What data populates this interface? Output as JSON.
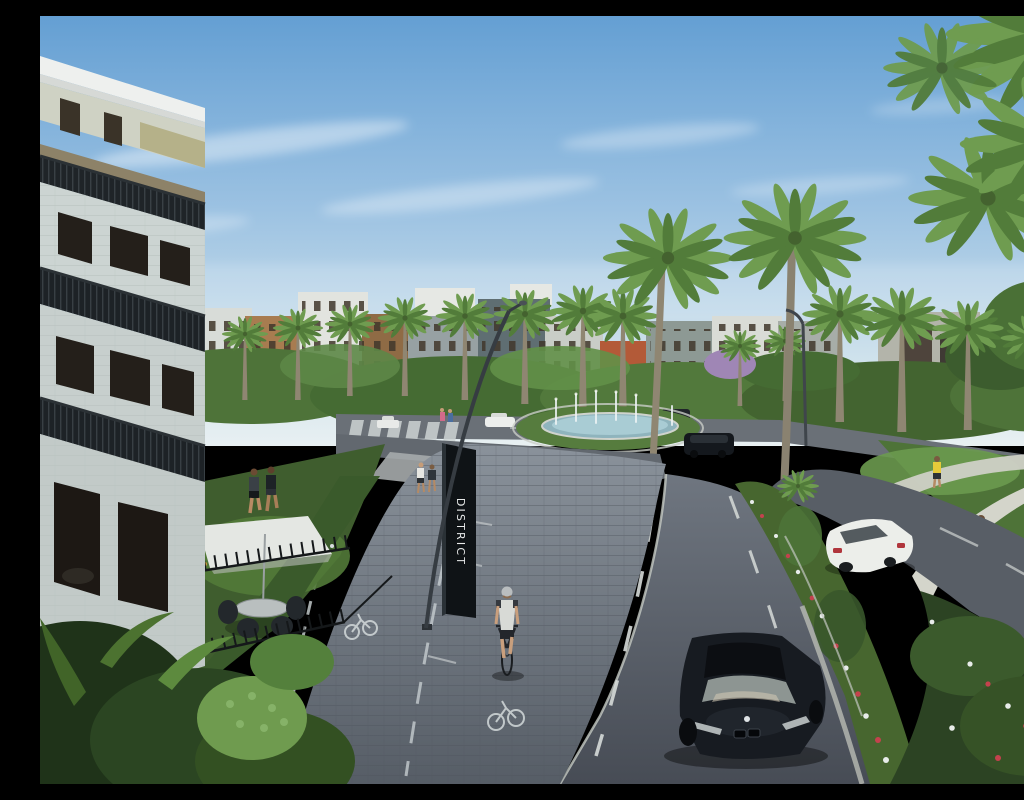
{
  "scene": {
    "kind": "photorealistic architectural rendering",
    "subject": "palm-lined boulevard curving through a modern residential community with a roundabout fountain, paver bike path and landscaped medians",
    "sky": "clear blue sky with thin wispy clouds"
  },
  "sign": {
    "label": "DISTRICT",
    "panel_color": "#0f1316",
    "text_color": "#e8eaea"
  },
  "palette": {
    "sky_top": "#649fd3",
    "sky_horizon": "#e8f0f2",
    "asphalt_near": "#474c55",
    "asphalt_far": "#6a7077",
    "paver_path": "#68717a",
    "lane_marking": "#d6dad8",
    "palm_frond_light": "#6f9c50",
    "palm_frond_dark": "#527c3a",
    "palm_trunk": "#8f8672",
    "foliage_dark": "#2c4323",
    "foliage_light": "#6f9b4f",
    "building_stone": "#ccd4d2",
    "building_brown": "#a87c50",
    "fountain_water": "#a9ccd4",
    "car_black": "#171b21",
    "car_white": "#eceeea",
    "umbrella": "#e4e7e3",
    "flower_red": "#c4424d",
    "flower_white": "#e8ecea"
  },
  "vehicles": [
    "black coupe driving toward viewer in foreground",
    "white sedan driving away on right carriageway",
    "silver suv approaching near crosswalk",
    "black suv rounding the fountain roundabout",
    "distant white cars near background buildings"
  ],
  "people": [
    "cyclist riding bike path toward viewer",
    "two joggers on lawn path at left",
    "couple walking on right garden path",
    "jogger in yellow shirt on upper right path",
    "pedestrians near mid sidewalk and crosswalk"
  ],
  "landmarks": [
    "three-story stone apartment building with dark balcony railings at left",
    "fenced yard with patio umbrella, table and chairs",
    "vertical DISTRICT monument sign",
    "curved modern street lamp over bike path",
    "oval roundabout fountain with water jets",
    "rows of tall palm trees lining the boulevard",
    "flat-roofed apartment blocks on the horizon",
    "purple flowering tree among background greenery"
  ]
}
